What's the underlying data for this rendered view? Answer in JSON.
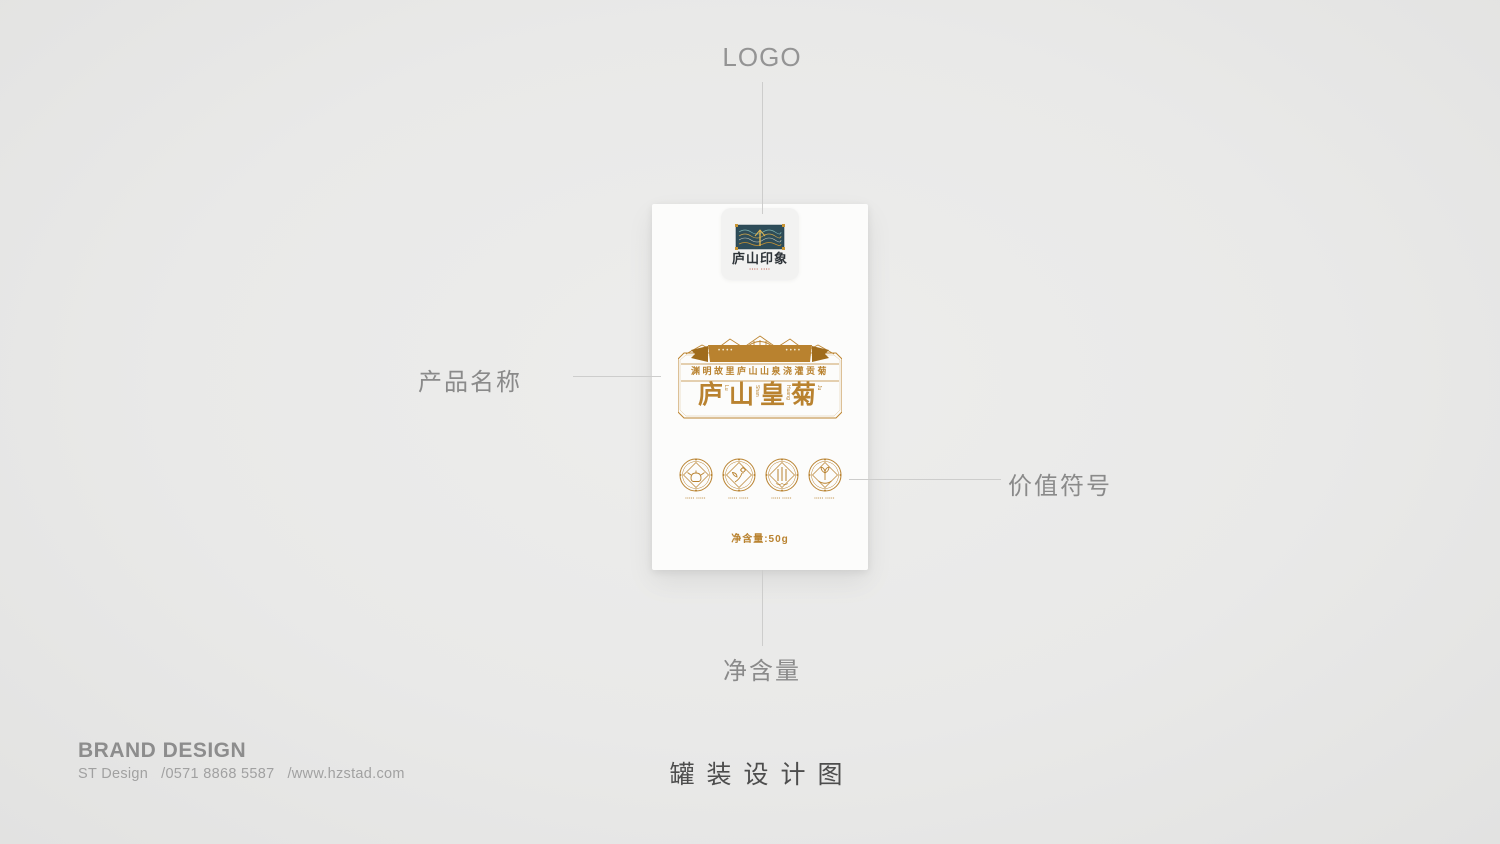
{
  "colors": {
    "gold": "#b9822f",
    "gold_dark": "#a06c1d",
    "plaque_teal": "#2e4d59",
    "seal_red": "#b5432f",
    "annotation_gray": "#8a8a8a",
    "leader_line_gray": "#cdcdcc"
  },
  "annotations": {
    "logo": "LOGO",
    "product_name": "产品名称",
    "value_symbols": "价值符号",
    "net_weight": "净含量"
  },
  "package": {
    "logo": {
      "calligraphy": "庐山印象",
      "seal_microtext": "•••• ••••"
    },
    "label": {
      "ribbon_left": "••••",
      "ribbon_right": "••••",
      "strip_text": "渊明故里庐山山泉浇灌贡菊",
      "title_chars": [
        "庐",
        "山",
        "皇",
        "菊"
      ],
      "title_pinyin": [
        "Lu",
        "Shan",
        "Huang",
        "Ju"
      ]
    },
    "value_icons": [
      {
        "name": "teapot-icon",
        "caption": "••••• •••••"
      },
      {
        "name": "flower-sprig-icon",
        "caption": "••••• •••••"
      },
      {
        "name": "waterfall-icon",
        "caption": "••••• •••••"
      },
      {
        "name": "hand-sprout-icon",
        "caption": "••••• •••••"
      }
    ],
    "net_weight_value": "净含量:50g"
  },
  "footer": {
    "brand_title": "BRAND DESIGN",
    "brand_sub": "ST Design   /0571 8868 5587   /www.hzstad.com",
    "caption": "罐装设计图"
  }
}
